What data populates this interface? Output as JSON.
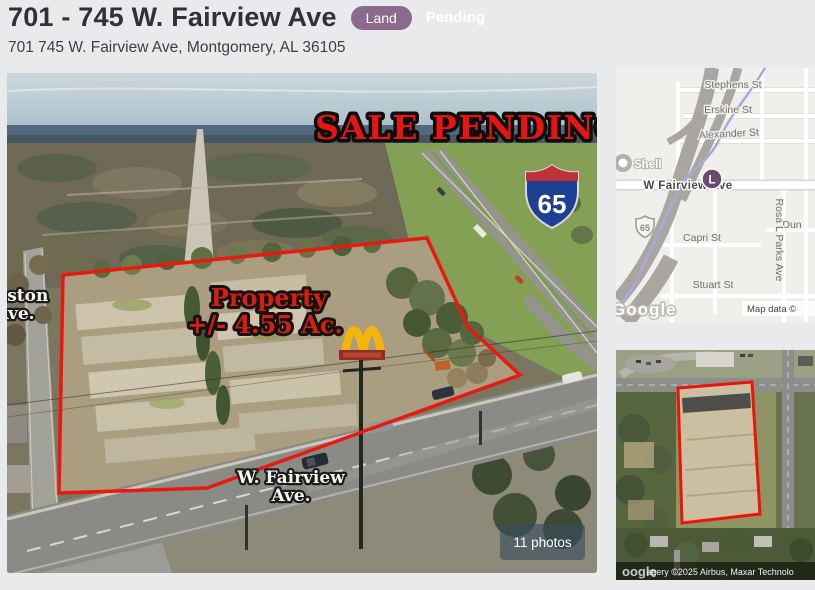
{
  "colors": {
    "accent_red": "#ea180e",
    "land_badge_purple": "#8a6b8d",
    "marker_purple": "#6b4a70",
    "interstate_blue": "#1e3f93",
    "mcdonalds_gold": "#f3b40c"
  },
  "header": {
    "title": "701 - 745 W. Fairview Ave",
    "type_badge": "Land",
    "status_badge": "Pending",
    "address": "701 745 W. Fairview Ave, Montgomery, AL 36105"
  },
  "photo": {
    "overlays": {
      "sale_pending": "SALE PENDING",
      "property_line1": "Property",
      "property_line2": "+/- 4.55 Ac.",
      "gaston_line1": "Gaston",
      "gaston_line2": "Ave.",
      "fairview_line1": "W. Fairview",
      "fairview_line2": "Ave.",
      "interstate_shield": "65",
      "photos_badge": "11 photos"
    }
  },
  "map": {
    "labels": {
      "stephens": "Stephens St",
      "erskine": "Erskine St",
      "alexander": "Alexander St",
      "shell": "Shell",
      "fairview": "W Fairview Ave",
      "marker": "L",
      "interstate": "65",
      "capri": "Capri St",
      "rosa_parks": "Rosa L Parks Ave",
      "dun": "Dun",
      "stuart": "Stuart St"
    },
    "watermark": "Google",
    "attribution": "Map data ©"
  },
  "satellite": {
    "watermark": "oogle",
    "attribution": "agery ©2025 Airbus, Maxar Technolo"
  }
}
